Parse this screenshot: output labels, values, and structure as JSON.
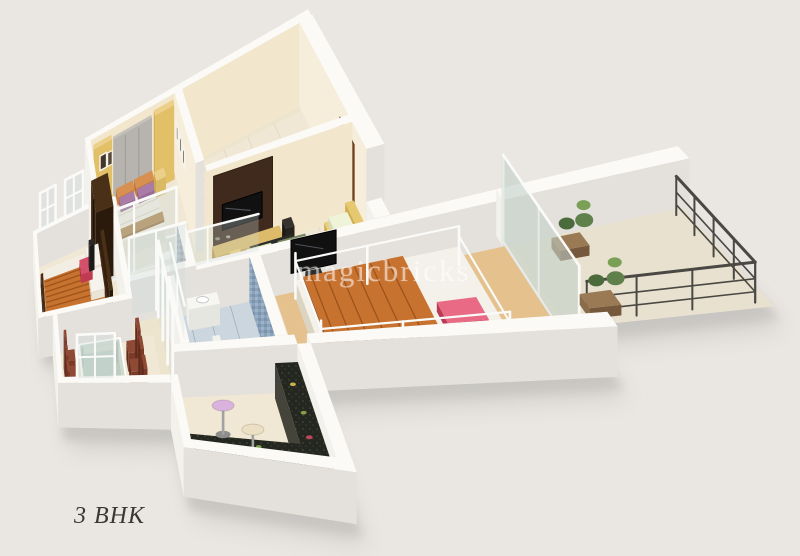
{
  "page": {
    "background": "#eae6e2",
    "label": "3 BHK",
    "watermark": "magicbricks",
    "render_type": "isometric-3d-floor-plan"
  },
  "floorplan": {
    "unit_type": "3 BHK",
    "rooms": [
      {
        "id": "bedroom-1",
        "name": "Bedroom 1 (top)",
        "items": [
          "double-bed",
          "orange-pillows",
          "purple-pillows",
          "gray-headboard-panel",
          "yellow-wardrobe-panels",
          "framed-pictures",
          "bedside-tables"
        ]
      },
      {
        "id": "bedroom-2",
        "name": "Bedroom 2 (left)",
        "items": [
          "dark-wood-bed",
          "orange-striped-blanket",
          "red-accent-pillow",
          "dark-wardrobe",
          "white-grid-windows",
          "tv-cabinet"
        ]
      },
      {
        "id": "bedroom-3",
        "name": "Bedroom 3 (right)",
        "items": [
          "bed-with-orange-striped-blanket",
          "white-frame-rails",
          "pink-cushion",
          "tv-on-stand",
          "glass-partition"
        ]
      },
      {
        "id": "living-room",
        "name": "Living Room",
        "items": [
          "yellow-sofa",
          "cushions",
          "tv-feature-panel",
          "wall-tv",
          "tv-cabinet",
          "black-coffee-table",
          "rug",
          "entrance-door"
        ]
      },
      {
        "id": "dining-room",
        "name": "Dining Room",
        "items": [
          "glass-dining-table",
          "six-brown-chairs",
          "window"
        ]
      },
      {
        "id": "kitchen",
        "name": "Kitchen",
        "items": [
          "granite-counters",
          "bar-stool-lavender",
          "bar-stool-cream"
        ]
      },
      {
        "id": "bathroom-1",
        "name": "Bathroom (blue mosaic)",
        "items": [
          "toilet",
          "washbasin",
          "glass-panels"
        ]
      },
      {
        "id": "bathroom-2",
        "name": "Bathroom (gray mosaic)",
        "items": [
          "shower-glass",
          "shower-tray",
          "washbasin"
        ]
      },
      {
        "id": "balcony",
        "name": "Balcony",
        "items": [
          "metal-railing",
          "plants"
        ]
      }
    ],
    "palette": {
      "bg": "#eae6e2",
      "shadow": "#c6c3bf",
      "wallTop": "#fbfaf7",
      "wallSouth": "#e4e1dc",
      "wallWest": "#f3f1ec",
      "creamS": "#f2e7cd",
      "creamW": "#f6eeda",
      "floor1": "#f0e8d4",
      "floor2": "#ede4ce",
      "floorBath1": "#ccd6de",
      "floorBath2": "#b4bdc4",
      "floorWood": "#e5c18d",
      "plank": "#d2ab72",
      "balconyFloor": "#e8e1cf",
      "rug": "#c9cfb7",
      "rugLine": "#b2b9a0",
      "woodDark": "#38240f",
      "woodDark2": "#241505",
      "doorWood": "#8a5632",
      "headboard": "#b7b3ae",
      "panelYellow": "#e2c068",
      "white": "#f4f1e9",
      "pillowOrange": "#c9803f",
      "pillowPurple": "#9a6b96",
      "blanket": "#c8722f",
      "blanketLine": "#9e531b",
      "accentRed": "#c03a52",
      "accentPink": "#d84a68",
      "sofa": "#e3c267",
      "sofaDark": "#cfae4e",
      "cushA": "#dde3b2",
      "cushB": "#6b7550",
      "tvBlack": "#111111",
      "panelDark": "#3f2a1d",
      "cabinet": "#c9a753",
      "cabinetW": "#b8963f",
      "cabinetT": "#dcbb6b",
      "glassTable": "#c2d2cb",
      "chair": "#7b3a28",
      "chairDark": "#5f2b1d",
      "granite": "#24271f",
      "graniteS": "#3b3a32",
      "stoolLav": "#d9b2de",
      "stoolCream": "#ece0c4",
      "chrome": "#a0a1a1",
      "rail": "#4a4843",
      "plant1": "#5f804a",
      "plant2": "#79a055",
      "plant3": "#4c6b3c",
      "pot": "#8a6b4a",
      "glass": "#ccd9d6",
      "frame": "#fafaf8",
      "mosaicB1": "#8ba3ba",
      "mosaicB2": "#7b93ac",
      "mosaicG1": "#a9b1b9",
      "mosaicG2": "#99a3ad"
    }
  }
}
